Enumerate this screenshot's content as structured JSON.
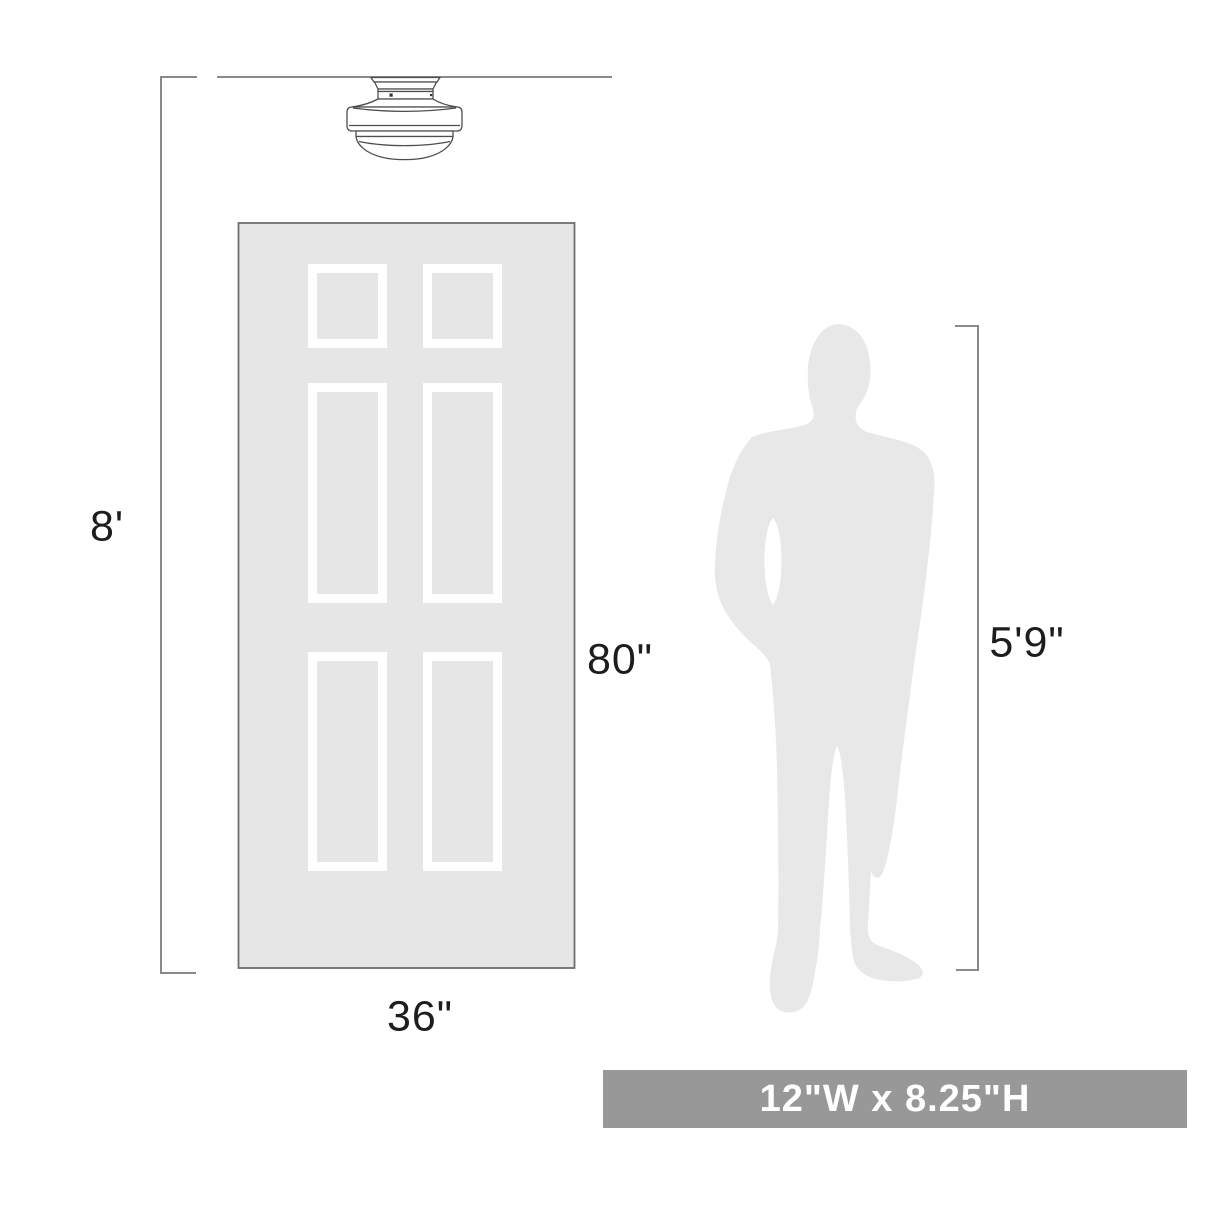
{
  "labels": {
    "ceiling_height": "8'",
    "door_height": "80\"",
    "door_width": "36\"",
    "person_height": "5'9\""
  },
  "banner": {
    "size_text": "12\"W x 8.25\"H"
  },
  "colors": {
    "door_fill": "#e6e6e6",
    "door_border": "#6e6e6e",
    "panel_frame": "#ffffff",
    "person_fill": "#e8e8e8",
    "dimension_line": "#8a8a8a",
    "label_text": "#1d1d1f",
    "banner_bg": "#989898",
    "banner_text": "#ffffff",
    "fixture_stroke": "#4d4d4d"
  },
  "icons": {
    "fixture": "schoolhouse-flush-mount-light",
    "person": "standing-man-silhouette",
    "door": "six-panel-door"
  }
}
